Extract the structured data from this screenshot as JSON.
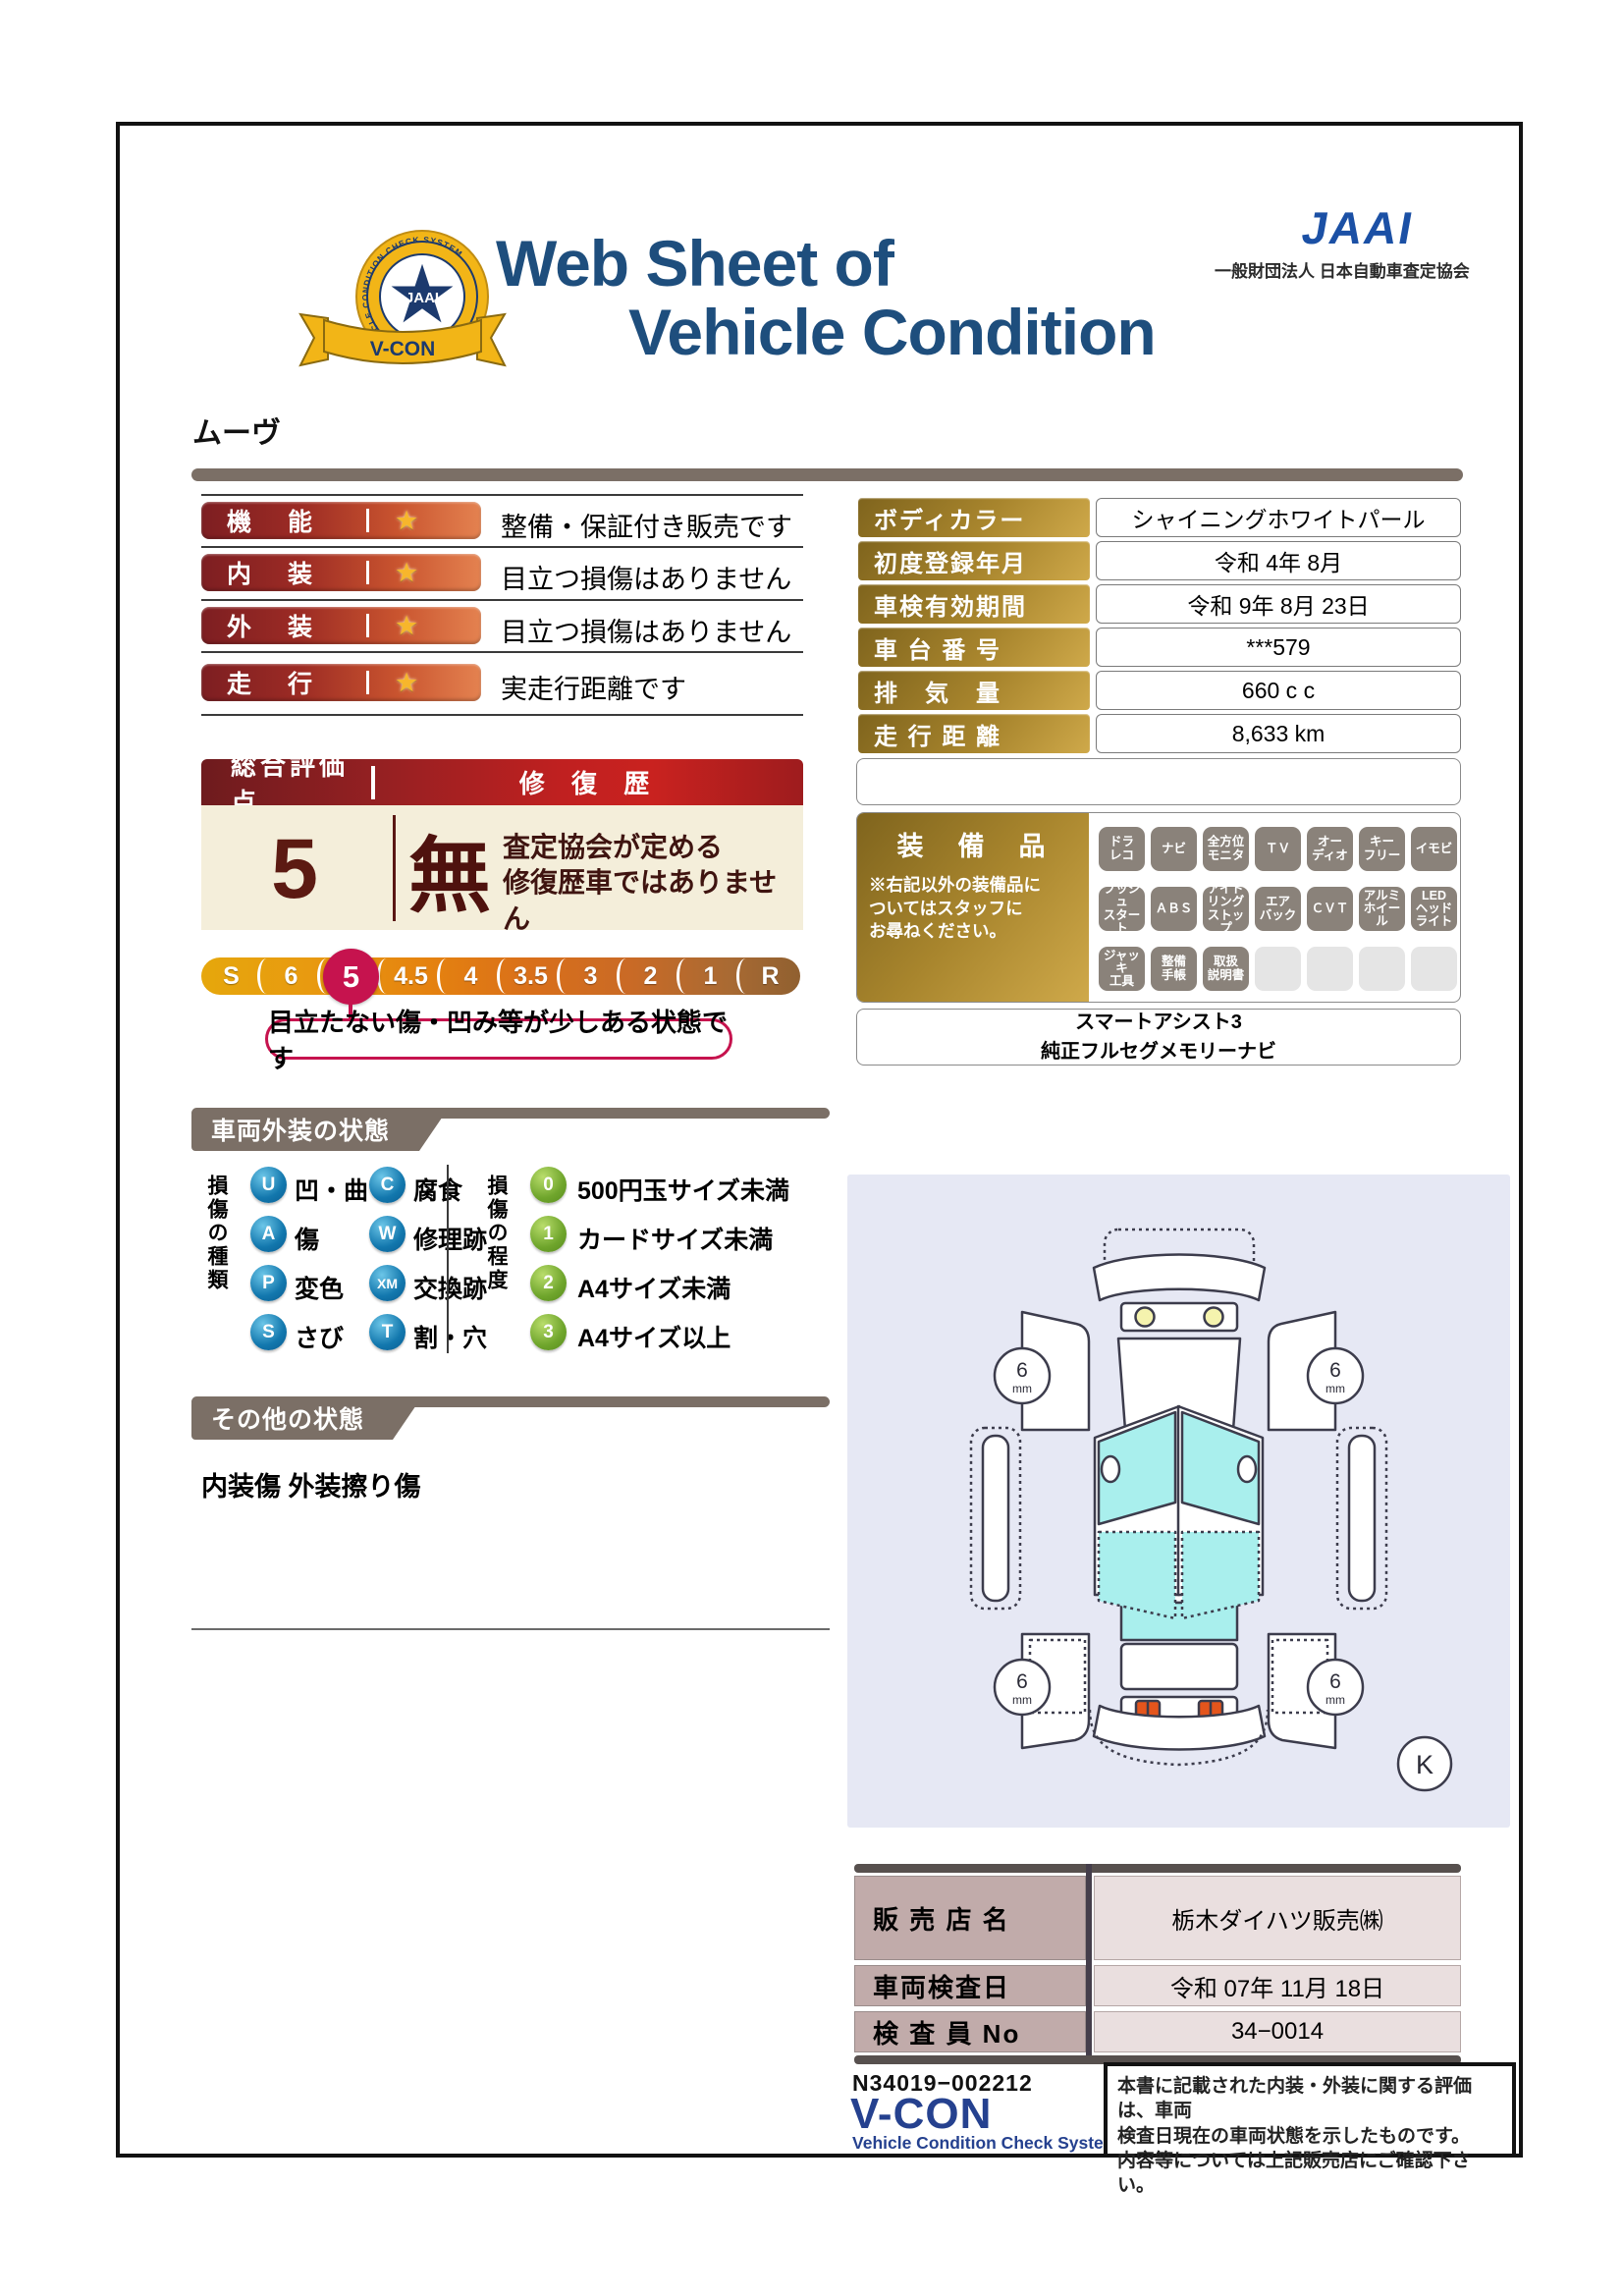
{
  "header": {
    "badge": {
      "ring_text": "VEHICLE CONDITION CHECK SYSTEM",
      "center": "JAAI",
      "ribbon": "V-CON"
    },
    "title_line1": "Web Sheet of",
    "title_line2": "Vehicle Condition",
    "jaai_logo": "JAAI",
    "jaai_org": "一般財団法人 日本自動車査定協会"
  },
  "vehicle_name": "ムーヴ",
  "ratings": [
    {
      "label": "機　能",
      "star": "★",
      "comment": "整備・保証付き販売です"
    },
    {
      "label": "内　装",
      "star": "★",
      "comment": "目立つ損傷はありません"
    },
    {
      "label": "外　装",
      "star": "★",
      "comment": "目立つ損傷はありません"
    },
    {
      "label": "走　行",
      "star": "★",
      "comment": "実走行距離です"
    }
  ],
  "overall": {
    "header_left": "総合評価点",
    "header_right": "修 復 歴",
    "score": "5",
    "repair_status": "無",
    "repair_note": "査定協会が定める\n修復歴車ではありません"
  },
  "scale": {
    "items": [
      "S",
      "6",
      "5",
      "4.5",
      "4",
      "3.5",
      "3",
      "2",
      "1",
      "R"
    ],
    "selected": "5",
    "callout": "目立たない傷・凹み等が少しある状態です"
  },
  "info_table": {
    "rows": [
      {
        "label": "ボディカラー",
        "value": "シャイニングホワイトパール"
      },
      {
        "label": "初度登録年月",
        "value": "令和 4年 8月"
      },
      {
        "label": "車検有効期間",
        "value": "令和 9年 8月 23日"
      },
      {
        "label": "車 台 番 号",
        "value": "***579"
      },
      {
        "label": "排　気　量",
        "value": "660 c c"
      },
      {
        "label": "走 行 距 離",
        "value": "8,633 km"
      }
    ]
  },
  "equipment": {
    "title": "装　備　品",
    "note": "※右記以外の装備品に\nついてはスタッフに\nお尋ねください。",
    "badges": [
      "ドラ\nレコ",
      "ナビ",
      "全方位\nモニタ",
      "ＴＶ",
      "オー\nディオ",
      "キー\nフリー",
      "イモビ",
      "プッシュ\nスタート",
      "ＡＢＳ",
      "アイド\nリング\nストップ",
      "エア\nバック",
      "ＣＶＴ",
      "アルミ\nホイール",
      "LED\nヘッド\nライト",
      "ジャッキ\n工具",
      "整備\n手帳",
      "取扱\n説明書",
      "",
      "",
      "",
      ""
    ],
    "extra": "スマートアシスト3\n純正フルセグメモリーナビ"
  },
  "exterior": {
    "title": "車両外装の状態",
    "types_label": "損傷の種類",
    "types": [
      {
        "code": "U",
        "label": "凹・曲"
      },
      {
        "code": "C",
        "label": "腐食"
      },
      {
        "code": "A",
        "label": "傷"
      },
      {
        "code": "W",
        "label": "修理跡"
      },
      {
        "code": "P",
        "label": "変色"
      },
      {
        "code": "XM",
        "label": "交換跡"
      },
      {
        "code": "S",
        "label": "さび"
      },
      {
        "code": "T",
        "label": "割・穴"
      }
    ],
    "degrees_label": "損傷の程度",
    "degrees": [
      {
        "code": "0",
        "label": "500円玉サイズ未満"
      },
      {
        "code": "1",
        "label": "カードサイズ未満"
      },
      {
        "code": "2",
        "label": "A4サイズ未満"
      },
      {
        "code": "3",
        "label": "A4サイズ以上"
      }
    ]
  },
  "other": {
    "title": "その他の状態",
    "note": "内装傷 外装擦り傷"
  },
  "diagram": {
    "tread_values": [
      "6",
      "6",
      "6",
      "6"
    ],
    "tread_unit": "mm",
    "marker": "K"
  },
  "dealer": {
    "rows": [
      {
        "label": "販 売 店 名",
        "value": "栃木ダイハツ販売㈱"
      },
      {
        "label": "車両検査日",
        "value": "令和 07年 11月 18日"
      },
      {
        "label": "検 査 員 No",
        "value": "34−0014"
      }
    ]
  },
  "footer": {
    "serial": "N34019−002212",
    "vcon": "V-CON",
    "vcon_sub": "Vehicle Condition Check System",
    "disclaimer": "本書に記載された内装・外装に関する評価は、車両\n検査日現在の車両状態を示したものです。\n内容等については上記販売店にご確認下さい。"
  }
}
